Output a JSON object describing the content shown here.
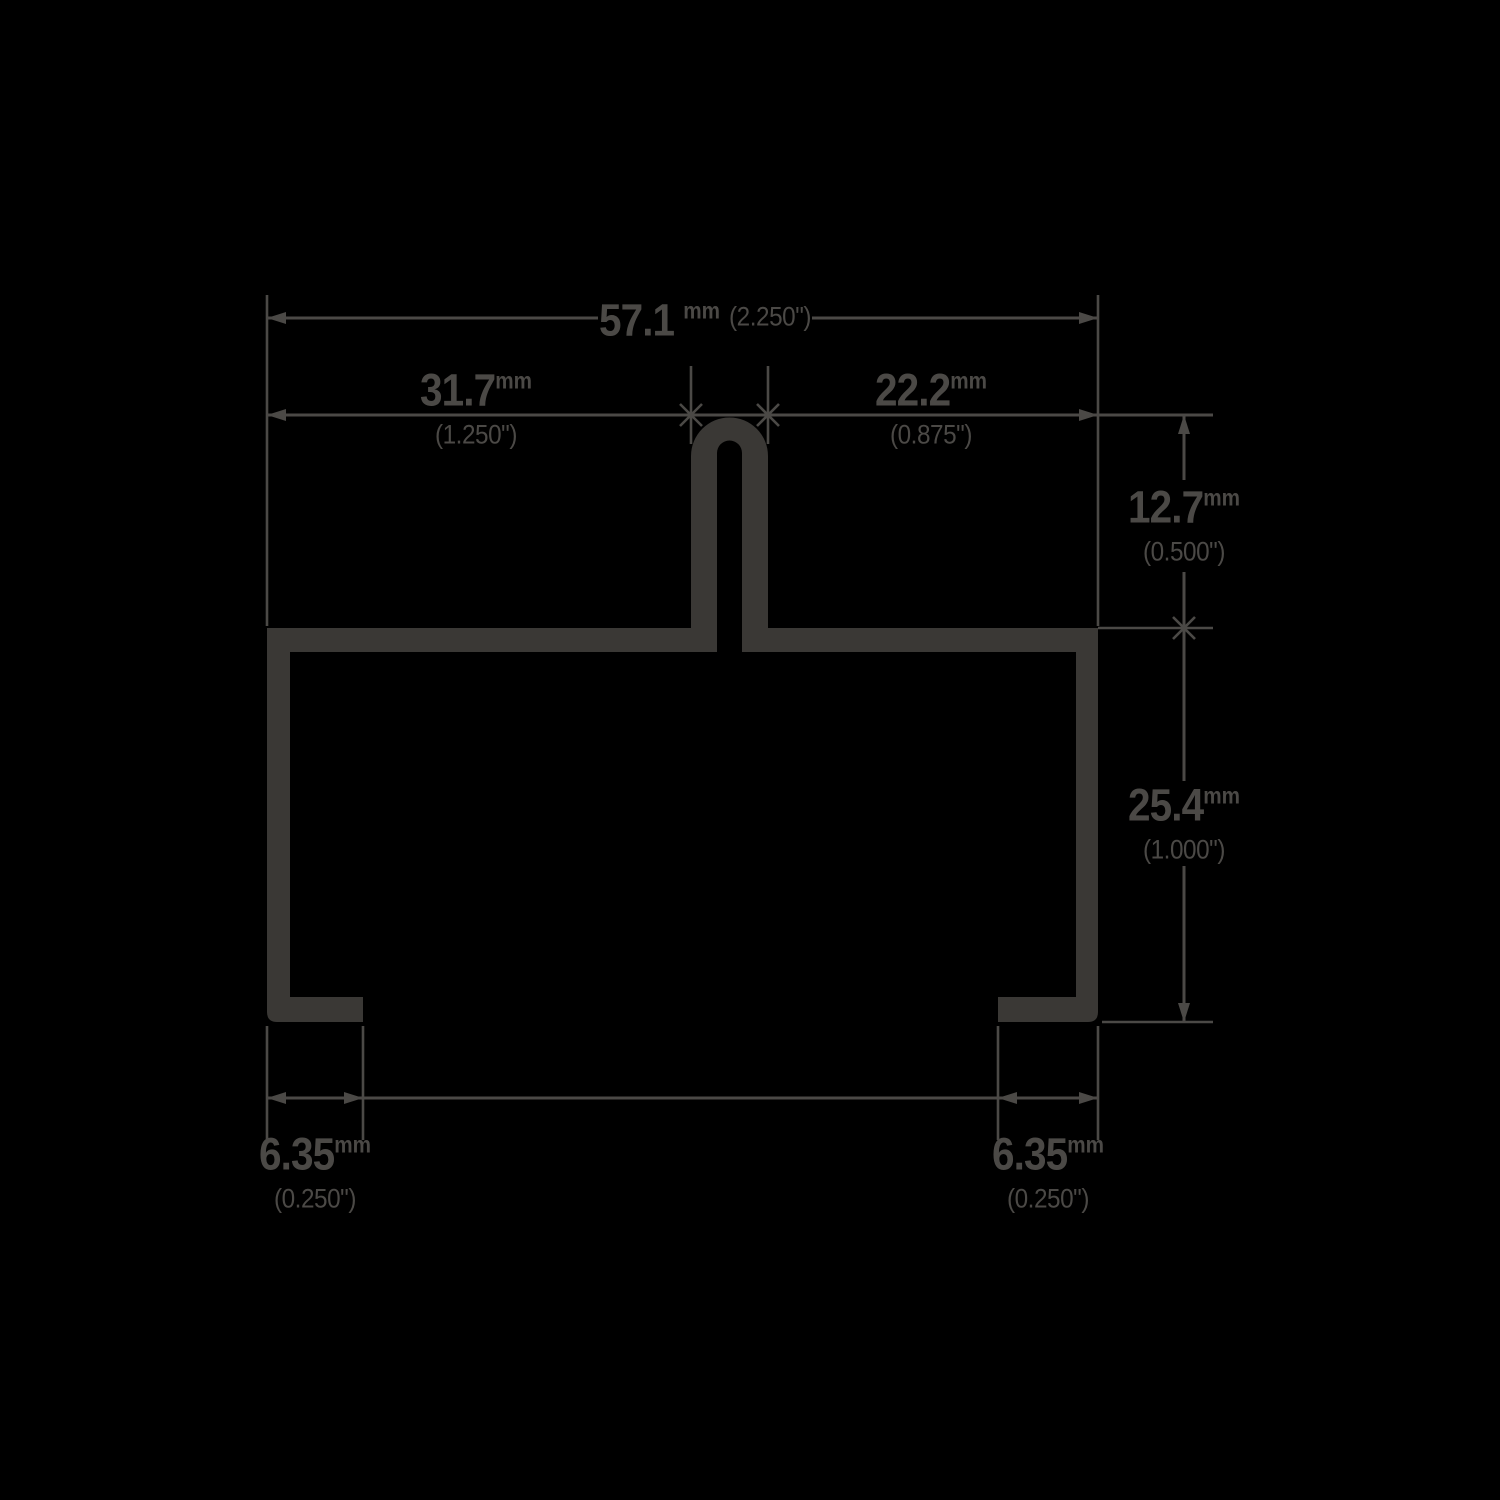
{
  "drawing": {
    "type": "technical-cross-section-dimension-drawing",
    "dimensions": {
      "overall_width": {
        "value_mm": "57.1",
        "unit": "mm",
        "value_in": "(2.250\")"
      },
      "left_segment": {
        "value_mm": "31.7",
        "unit": "mm",
        "value_in": "(1.250\")"
      },
      "right_segment": {
        "value_mm": "22.2",
        "unit": "mm",
        "value_in": "(0.875\")"
      },
      "seam_height": {
        "value_mm": "12.7",
        "unit": "mm",
        "value_in": "(0.500\")"
      },
      "body_height": {
        "value_mm": "25.4",
        "unit": "mm",
        "value_in": "(1.000\")"
      },
      "left_foot_width": {
        "value_mm": "6.35",
        "unit": "mm",
        "value_in": "(0.250\")"
      },
      "right_foot_width": {
        "value_mm": "6.35",
        "unit": "mm",
        "value_in": "(0.250\")"
      }
    },
    "colors": {
      "background": "#000000",
      "profile": "#3a3835",
      "annotation": "#4b4946"
    }
  }
}
